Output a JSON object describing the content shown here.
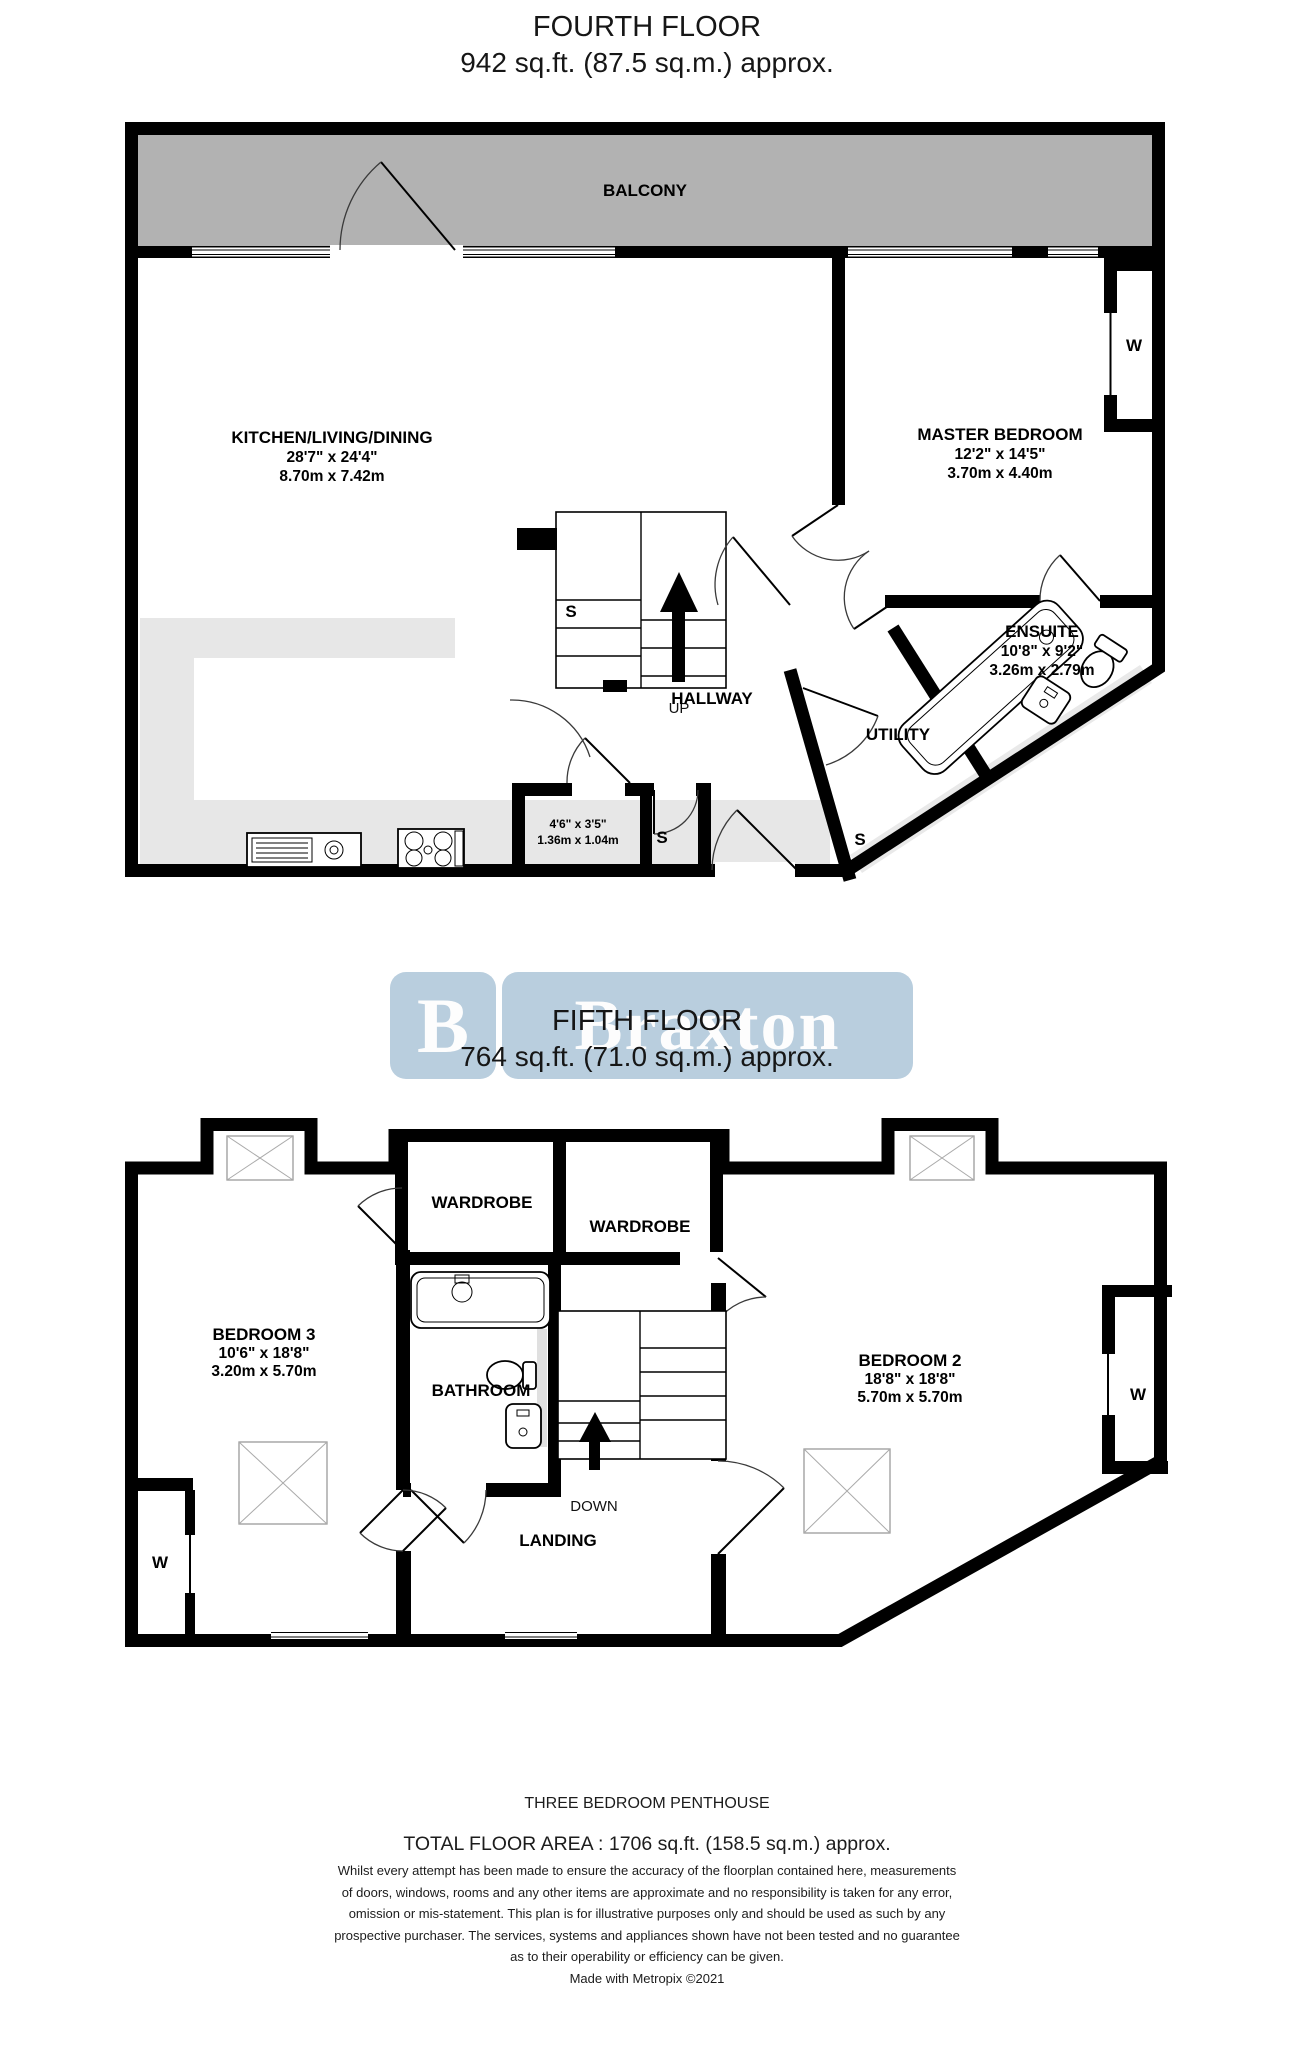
{
  "floors": [
    {
      "title": "FOURTH FLOOR",
      "area": "942 sq.ft. (87.5 sq.m.) approx.",
      "balcony": "BALCONY",
      "kitchen": {
        "label": "KITCHEN/LIVING/DINING",
        "imperial": "28'7\"  x 24'4\"",
        "metric": "8.70m  x 7.42m"
      },
      "master": {
        "label": "MASTER BEDROOM",
        "imperial": "12'2\"  x 14'5\"",
        "metric": "3.70m  x 4.40m"
      },
      "ensuite": {
        "label": "ENSUITE",
        "imperial": "10'8\"  x 9'2\"",
        "metric": "3.26m  x 2.79m"
      },
      "hallway": {
        "label": "HALLWAY",
        "direction": "UP"
      },
      "utility": {
        "label": "UTILITY"
      },
      "store": {
        "imperial": "4'6\"  x 3'5\"",
        "metric": "1.36m  x 1.04m"
      },
      "s_label": "S",
      "w_label": "W"
    },
    {
      "title": "FIFTH FLOOR",
      "area": "764 sq.ft. (71.0 sq.m.) approx.",
      "bedroom3": {
        "label": "BEDROOM 3",
        "imperial": "10'6\"  x 18'8\"",
        "metric": "3.20m  x 5.70m"
      },
      "bedroom2": {
        "label": "BEDROOM 2",
        "imperial": "18'8\"  x 18'8\"",
        "metric": "5.70m  x 5.70m"
      },
      "bathroom": {
        "label": "BATHROOM"
      },
      "landing": {
        "label": "LANDING",
        "direction": "DOWN"
      },
      "wardrobe": "WARDROBE",
      "w_label": "W"
    }
  ],
  "watermark": {
    "brand": "Braxton",
    "logo_letter": "B",
    "color": "#b9cede"
  },
  "footer": {
    "type": "THREE BEDROOM PENTHOUSE",
    "total": "TOTAL FLOOR AREA : 1706 sq.ft. (158.5 sq.m.) approx.",
    "disclaimer_lines": [
      "Whilst every attempt has been made to ensure the accuracy of the floorplan contained here, measurements",
      "of doors, windows, rooms and any other items are approximate and no responsibility is taken for any error,",
      "omission or mis-statement. This plan is for illustrative purposes only and should be used as such by any",
      "prospective purchaser. The services, systems and appliances shown have not been tested and no guarantee",
      "as to their operability or efficiency can be given."
    ],
    "credit": "Made with Metropix ©2021"
  }
}
